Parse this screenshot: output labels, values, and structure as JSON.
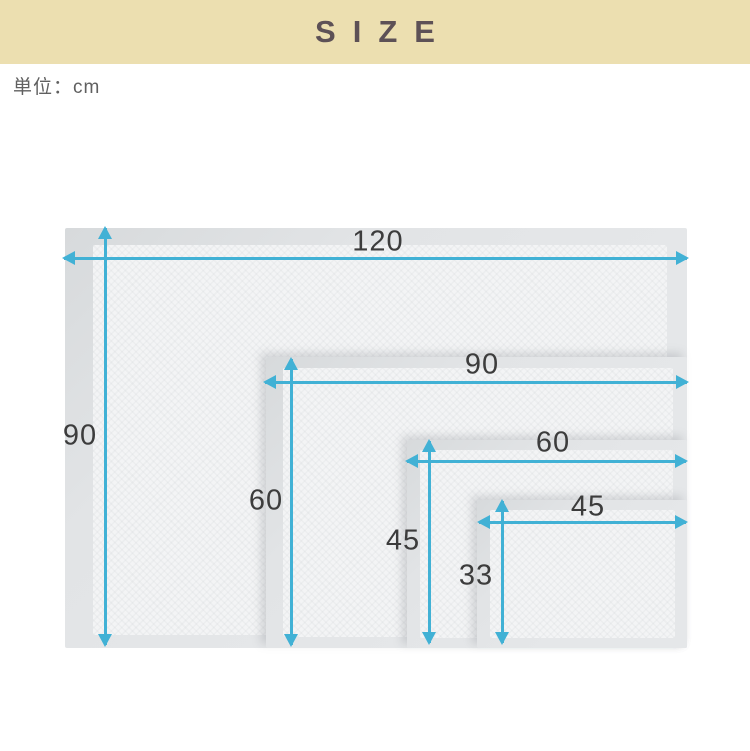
{
  "banner": {
    "title": "SIZE"
  },
  "unit_label": "単位：cm",
  "pads": [
    {
      "name": "pad-120x90",
      "width_label": "120",
      "height_label": "90"
    },
    {
      "name": "pad-90x60",
      "width_label": "90",
      "height_label": "60"
    },
    {
      "name": "pad-60x45",
      "width_label": "60",
      "height_label": "45"
    },
    {
      "name": "pad-45x33",
      "width_label": "45",
      "height_label": "33"
    }
  ],
  "colors": {
    "banner_bg": "#ecdfb0",
    "banner_text": "#5d5156",
    "arrow": "#41b1d5",
    "dimension_text": "#3c3c3c",
    "unit_text": "#606060",
    "pad_border": "#e5e7e9",
    "pad_inner": "#f3f4f5"
  }
}
